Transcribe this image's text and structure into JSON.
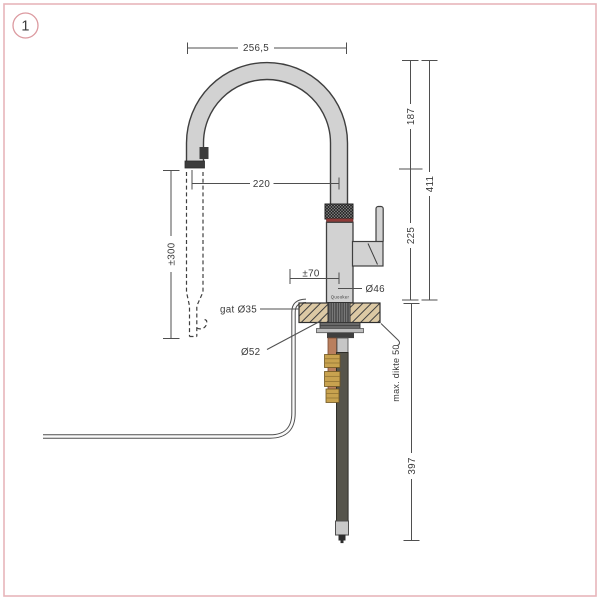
{
  "frame": {
    "figure_number": "1"
  },
  "product": {
    "brand_label": "Quooker"
  },
  "dims": {
    "spout_width": "256,5",
    "spout_reach": "220",
    "hose_pullout": "±300",
    "base_offset": "±70",
    "body_diameter": "Ø46",
    "mounting_hole": "gat Ø35",
    "flange_diameter": "Ø52",
    "max_counter_thickness": "max. dikte 50",
    "height_top_to_spout_tip": "187",
    "height_spout_tip_to_counter": "225",
    "height_total_above_counter": "411",
    "depth_below_counter": "397"
  },
  "colors": {
    "accent_border": "#e7b6ba",
    "figure_number": "#c2606a",
    "faucet_fill": "#d2d2d2",
    "outline": "#3f3f3f",
    "red_ring": "#8f3a38",
    "counter_fill": "#dcc9a4",
    "copper": "#b97f5e",
    "brass": "#c8a24f",
    "dark_tube": "#56544b",
    "dim_line": "#4f4f4f",
    "dim_text": "#3a3a3a"
  }
}
